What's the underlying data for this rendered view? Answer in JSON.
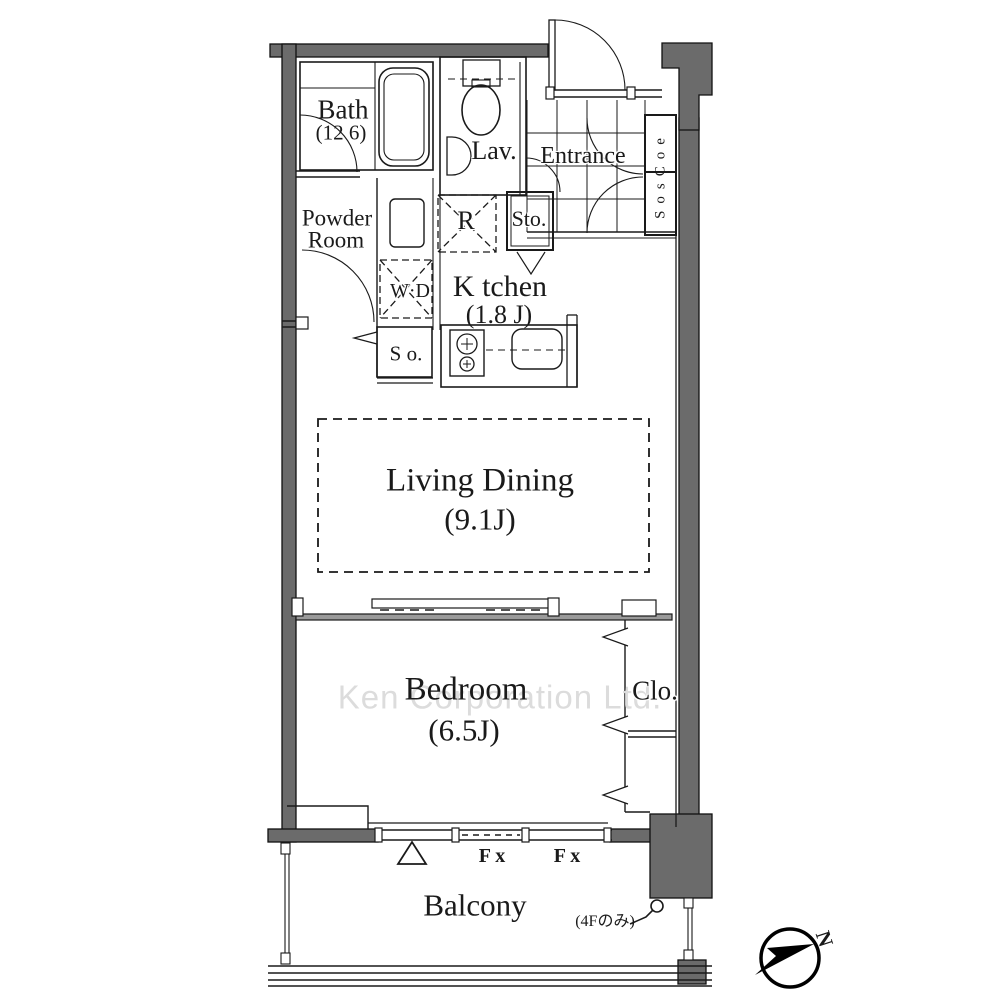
{
  "rooms": {
    "bath": {
      "label": "Bath",
      "size": "(12 6)"
    },
    "lavatory": {
      "label": "Lav."
    },
    "entrance": {
      "label": "Entrance"
    },
    "shoes_closet_vertical": {
      "label": "SosCoe"
    },
    "powder_room": {
      "label_line1": "Powder",
      "label_line2": "Room"
    },
    "washer_dryer": {
      "label": "W·D"
    },
    "refrigerator": {
      "label": "R"
    },
    "storage": {
      "label": "Sto."
    },
    "kitchen": {
      "label": "K tchen",
      "size": "(1.8 J)"
    },
    "storage_small": {
      "label": "S o."
    },
    "living_dining": {
      "label": "Living Dining",
      "size": "(9.1J)"
    },
    "bedroom": {
      "label": "Bedroom",
      "size": "(6.5J)"
    },
    "closet": {
      "label": "Clo."
    },
    "balcony": {
      "label": "Balcony"
    }
  },
  "annotations": {
    "fix_window_1": "F x",
    "fix_window_2": "F x",
    "floor_note": "(4Fのみ)",
    "compass_north": "N",
    "watermark": "Ken Corporation Ltd."
  },
  "colors": {
    "wall_fill": "#6b6b6b",
    "line": "#1a1a1a",
    "watermark": "#dcdcdc",
    "background": "#ffffff"
  }
}
